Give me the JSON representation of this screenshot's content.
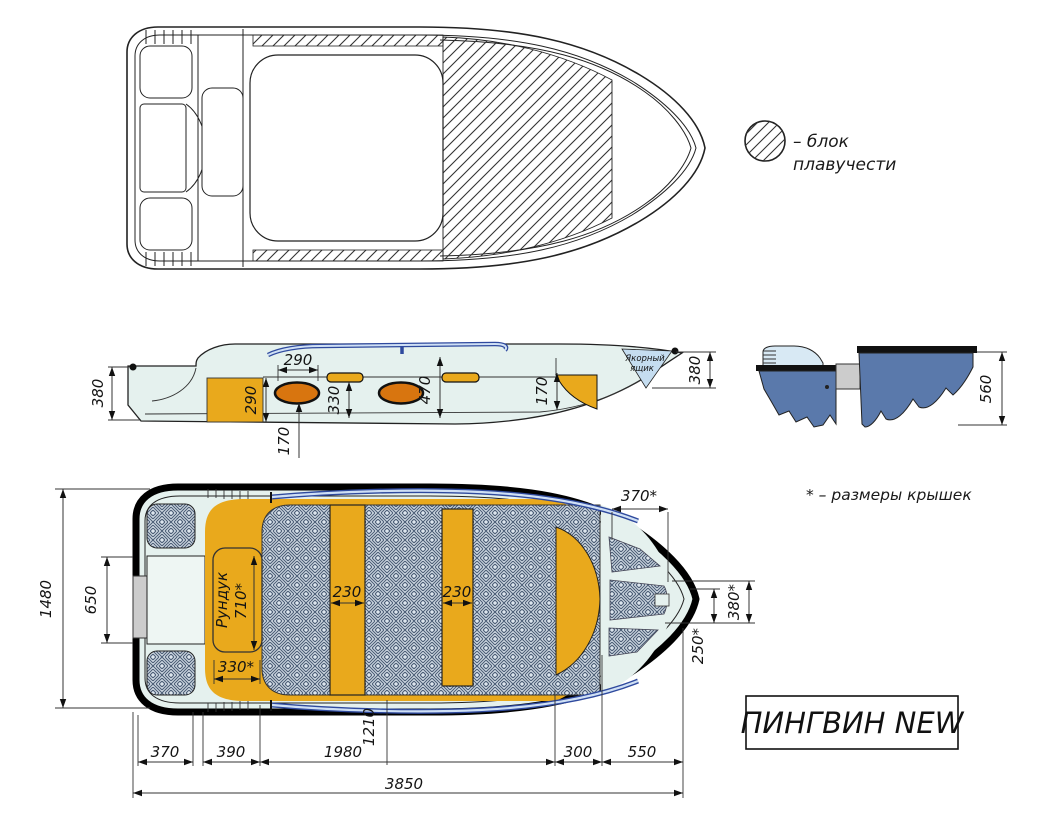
{
  "title": "ПИНГВИН NEW",
  "note": "* – размеры крышек",
  "legend": {
    "line1": "– блок",
    "line2": "плавучести"
  },
  "colors": {
    "hull_interior": "#e5f1ee",
    "deck_orange": "#e9a91c",
    "seat_orange": "#d8750f",
    "section_blue": "#5a79ab",
    "rail_blue": "#2f4a9e",
    "rail_light": "#cfe0f5",
    "anchor_blue": "#c5ddf0",
    "floor_pattern_bg": "#dde6ee",
    "floor_pattern_line": "#4e6078",
    "motor_plate_gray": "#cccccc"
  },
  "side_view": {
    "anchor_box": {
      "line1": "Якорный",
      "line2": "ящик"
    },
    "dims": {
      "stern_height": "380",
      "locker_height": "290",
      "seat_width": "290",
      "seat_floor": "170",
      "strip_width": "330",
      "cockpit_depth": "470",
      "bow_step": "170",
      "bow_height": "380"
    }
  },
  "section_view": {
    "dims": {
      "depth": "560"
    }
  },
  "plan_view": {
    "locker_label": "Рундук",
    "dims": {
      "beam": "1480",
      "transom_width": "650",
      "locker_length": "710*",
      "locker_width": "330*",
      "bench1_width": "230",
      "bench2_width": "230",
      "bow_hatch_width": "370*",
      "bow_width": "380*",
      "bow_cover": "250*",
      "cockpit_ref": "1210"
    }
  },
  "length_chain": {
    "segments": [
      "370",
      "390",
      "1980",
      "300",
      "550"
    ],
    "total": "3850"
  }
}
